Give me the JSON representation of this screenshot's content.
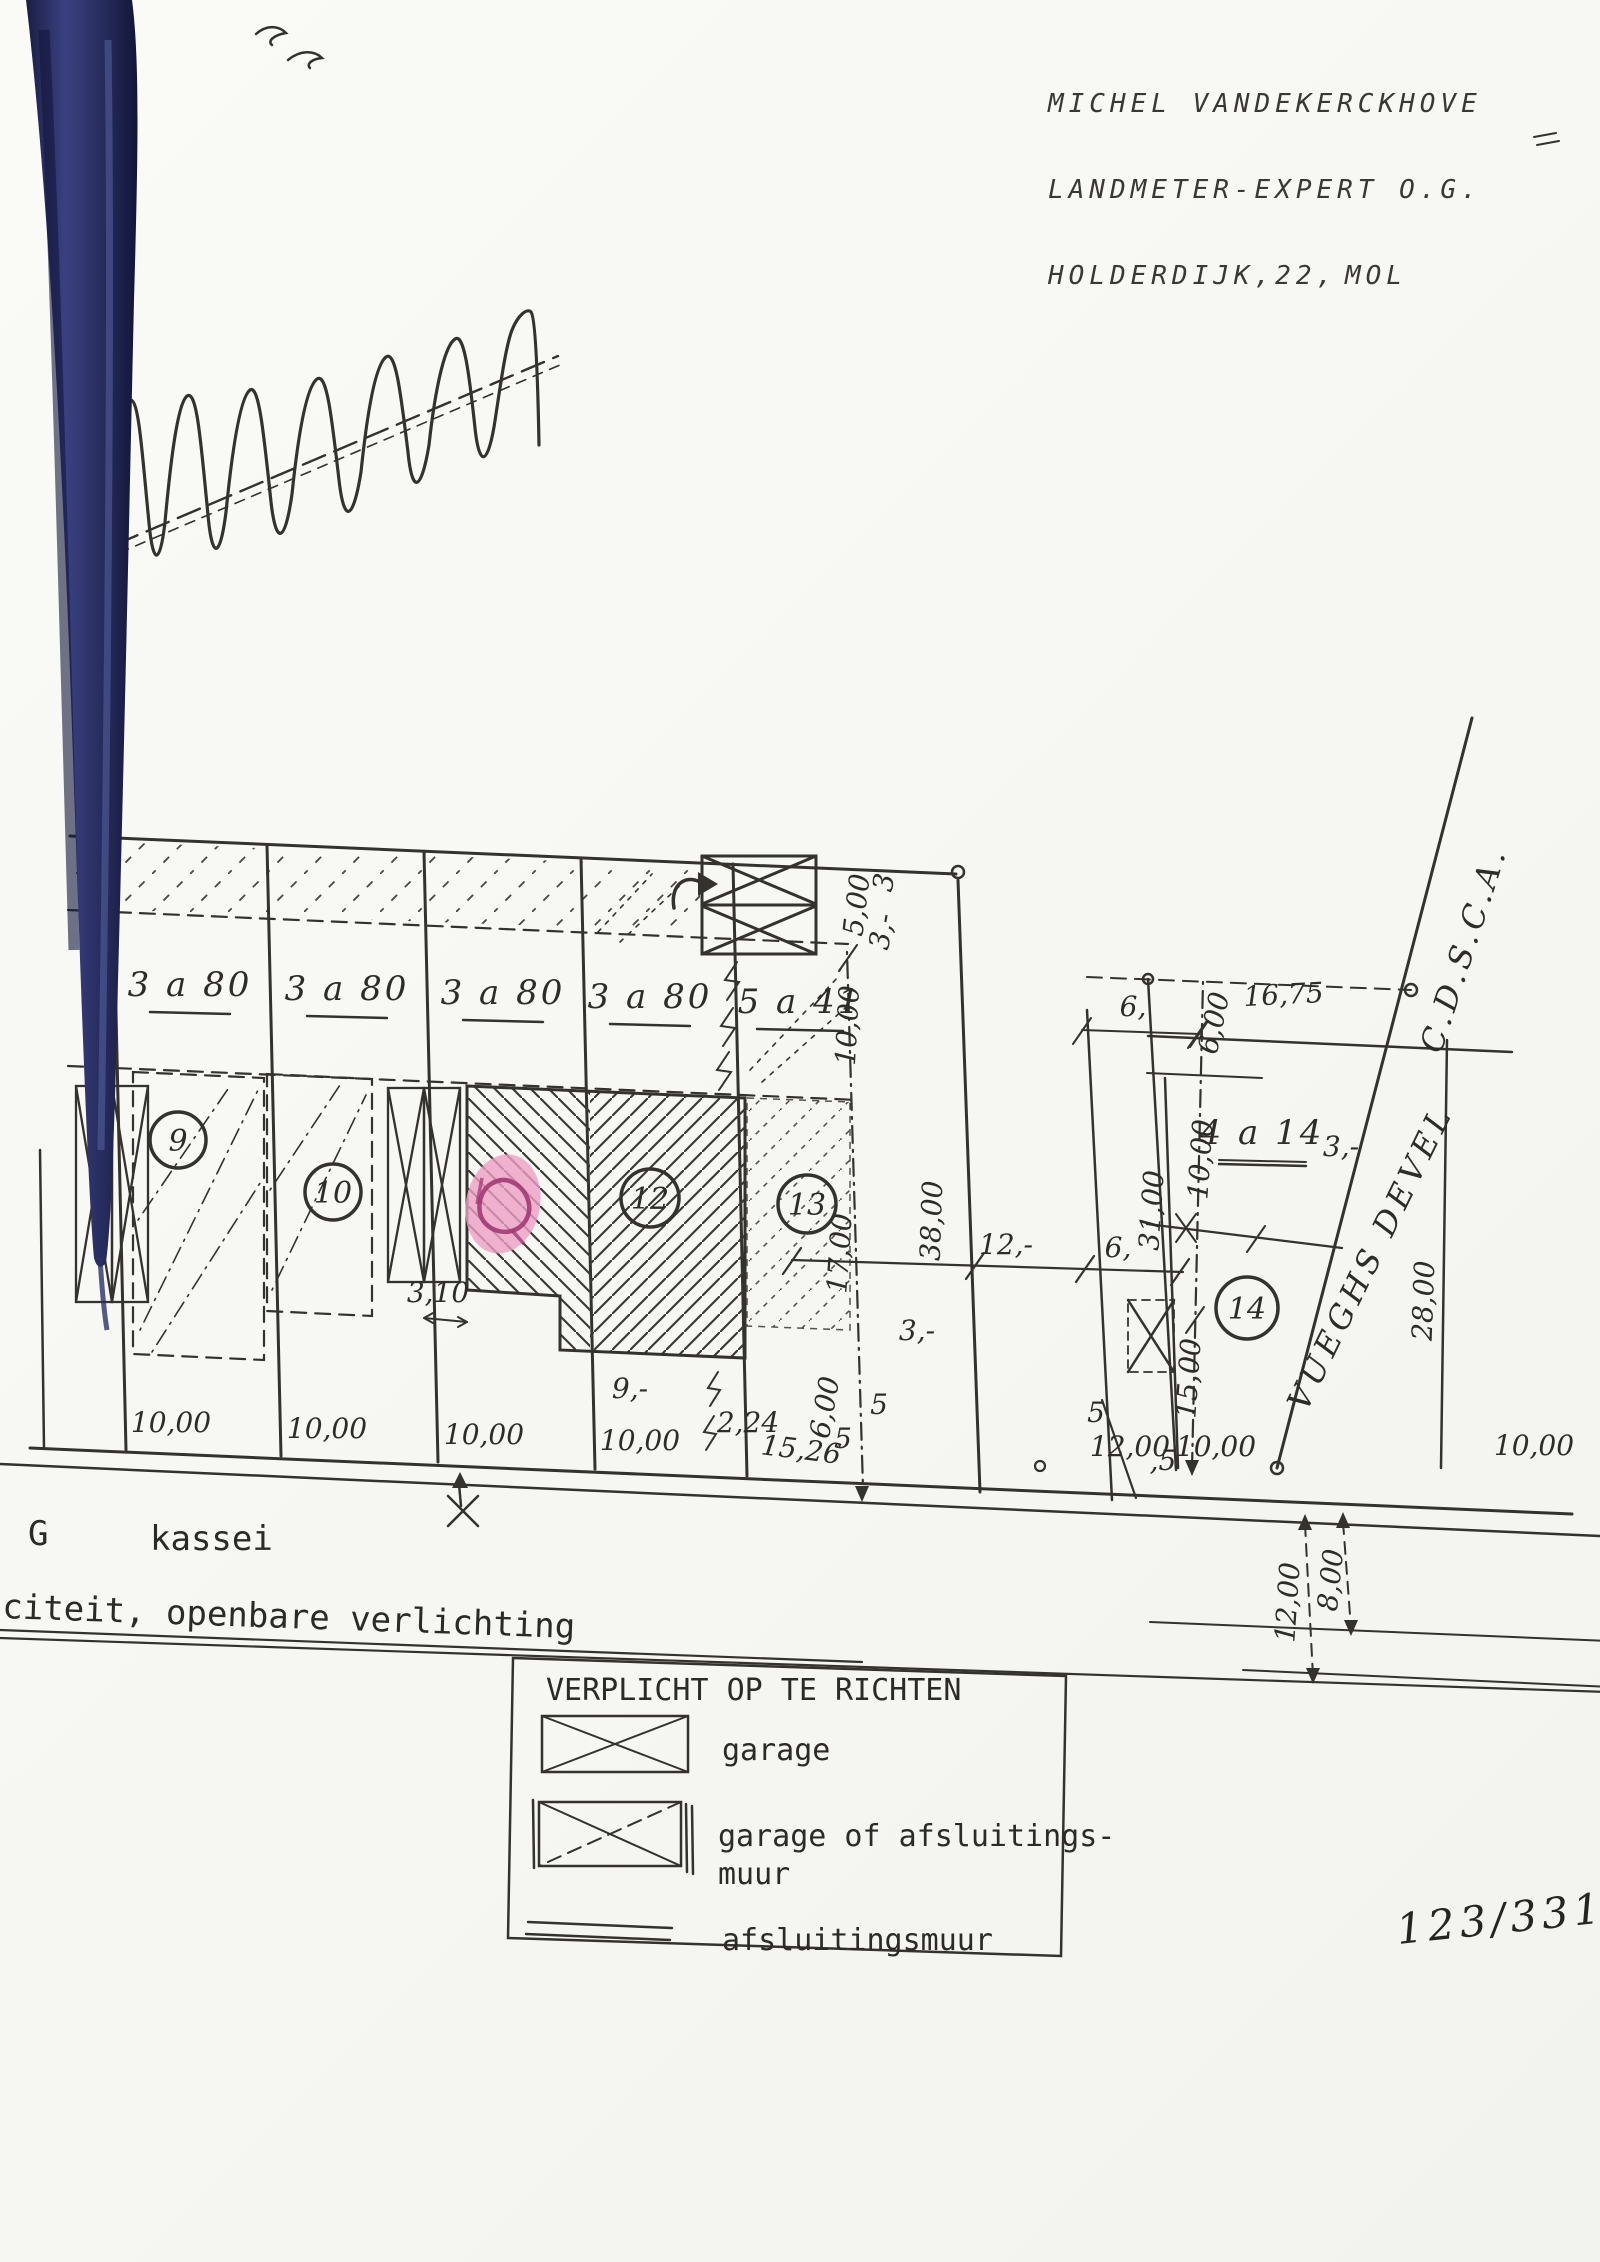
{
  "document": {
    "surveyor": {
      "line1": "MICHEL VANDEKERCKHOVE",
      "line2": "LANDMETER-EXPERT O.G.",
      "line3_left": "HOLDERDIJK,22,",
      "line3_right": "MOL"
    },
    "page_number": "123/331"
  },
  "plan": {
    "road_labels": {
      "cdsca": "C.D.S.C.A.",
      "vueghs_devel": "VUEGHS DEVEL"
    },
    "street_texts": {
      "g": "G",
      "kassei": "kassei",
      "verlichting": "citeit, openbare verlichting"
    },
    "labels": [
      {
        "t": "3 a 80",
        "x": 190,
        "y": 996,
        "cls": "t-area",
        "name": "area-label-plot9"
      },
      {
        "t": "3 a 80",
        "x": 347,
        "y": 1000,
        "cls": "t-area",
        "name": "area-label-plot10"
      },
      {
        "t": "3 a 80",
        "x": 503,
        "y": 1004,
        "cls": "t-area",
        "name": "area-label-plot11"
      },
      {
        "t": "3 a 80",
        "x": 650,
        "y": 1008,
        "cls": "t-area",
        "name": "area-label-plot12"
      },
      {
        "t": "5 a 41",
        "x": 800,
        "y": 1013,
        "cls": "t-area",
        "name": "area-label-plot13"
      },
      {
        "t": "4 a 14",
        "x": 1262,
        "y": 1144,
        "fs": 30,
        "cls": "t-area",
        "name": "area-label-plot-right"
      },
      {
        "t": "9",
        "x": 178,
        "y": 1151,
        "cls": "t-num",
        "name": "parcel-number-9"
      },
      {
        "t": "10",
        "x": 333,
        "y": 1203,
        "cls": "t-num",
        "name": "parcel-number-10"
      },
      {
        "t": "12",
        "x": 650,
        "y": 1209,
        "cls": "t-num",
        "name": "parcel-number-12"
      },
      {
        "t": "13",
        "x": 807,
        "y": 1215,
        "cls": "t-num",
        "name": "parcel-number-13"
      },
      {
        "t": "14",
        "x": 1247,
        "y": 1319,
        "cls": "t-num",
        "name": "parcel-number-14"
      },
      {
        "t": "10,00",
        "x": 171,
        "y": 1432
      },
      {
        "t": "10,00",
        "x": 327,
        "y": 1438
      },
      {
        "t": "10,00",
        "x": 484,
        "y": 1444
      },
      {
        "t": "10,00",
        "x": 640,
        "y": 1450
      },
      {
        "t": "2,24",
        "x": 748,
        "y": 1432,
        "fs": 24
      },
      {
        "t": "15,26",
        "x": 800,
        "y": 1459,
        "fs": 24,
        "r": 7
      },
      {
        "t": "5",
        "x": 843,
        "y": 1448,
        "fs": 22
      },
      {
        "t": "5",
        "x": 879,
        "y": 1414,
        "fs": 22
      },
      {
        "t": "9,-",
        "x": 630,
        "y": 1398,
        "fs": 24
      },
      {
        "t": "3,10",
        "x": 438,
        "y": 1302,
        "fs": 20
      },
      {
        "t": "12,00",
        "x": 1130,
        "y": 1456
      },
      {
        "t": ",5",
        "x": 1163,
        "y": 1470,
        "fs": 22
      },
      {
        "t": "5",
        "x": 1096,
        "y": 1422,
        "fs": 22
      },
      {
        "t": "10,00",
        "x": 1216,
        "y": 1456
      },
      {
        "t": "10,00",
        "x": 1534,
        "y": 1455
      },
      {
        "t": "12,-",
        "x": 1006,
        "y": 1254,
        "fs": 26
      },
      {
        "t": "6,",
        "x": 1133,
        "y": 1016,
        "fs": 26
      },
      {
        "t": "6,",
        "x": 1118,
        "y": 1257,
        "fs": 26
      },
      {
        "t": "16,75",
        "x": 1284,
        "y": 1004,
        "fs": 26,
        "r": -3
      },
      {
        "t": "3,-",
        "x": 1341,
        "y": 1156,
        "fs": 24
      },
      {
        "t": "3,-",
        "x": 917,
        "y": 1340,
        "fs": 24
      },
      {
        "t": "5,00",
        "x": 866,
        "y": 906,
        "fs": 24,
        "r": -83
      },
      {
        "t": "3",
        "x": 893,
        "y": 884,
        "fs": 22,
        "r": -80
      },
      {
        "t": "3,-",
        "x": 891,
        "y": 933,
        "fs": 22,
        "r": -80
      },
      {
        "t": "10,00",
        "x": 857,
        "y": 1026,
        "fs": 26,
        "r": -87
      },
      {
        "t": "17,00",
        "x": 849,
        "y": 1254,
        "fs": 26,
        "r": -86
      },
      {
        "t": "6,00",
        "x": 834,
        "y": 1409,
        "fs": 24,
        "r": -80
      },
      {
        "t": "38,00",
        "x": 941,
        "y": 1221,
        "fs": 28,
        "r": -88
      },
      {
        "t": "31,00",
        "x": 1161,
        "y": 1211,
        "fs": 26,
        "r": -86
      },
      {
        "t": "10,00",
        "x": 1210,
        "y": 1160,
        "fs": 26,
        "r": -86
      },
      {
        "t": "6,00",
        "x": 1223,
        "y": 1025,
        "fs": 24,
        "r": -78
      },
      {
        "t": "15,00",
        "x": 1198,
        "y": 1379,
        "fs": 24,
        "r": -86
      },
      {
        "t": "28,00",
        "x": 1433,
        "y": 1301,
        "fs": 28,
        "r": -88
      },
      {
        "t": "12,00",
        "x": 1297,
        "y": 1603,
        "fs": 24,
        "r": -86
      },
      {
        "t": "8,00",
        "x": 1340,
        "y": 1581,
        "fs": 24,
        "r": -84
      }
    ]
  },
  "legend": {
    "title": "VERPLICHT OP TE RICHTEN",
    "item_garage": "garage",
    "item_garage_muur_1": "garage of afsluitings-",
    "item_garage_muur_2": "muur",
    "item_muur": "afsluitingsmuur"
  },
  "colors": {
    "paper": "#f8f8f5",
    "ink": "#34322d",
    "binder_blue": "#2b3166",
    "stamp_pink": "#ec9fc4",
    "stamp_ink": "#a23a74"
  }
}
